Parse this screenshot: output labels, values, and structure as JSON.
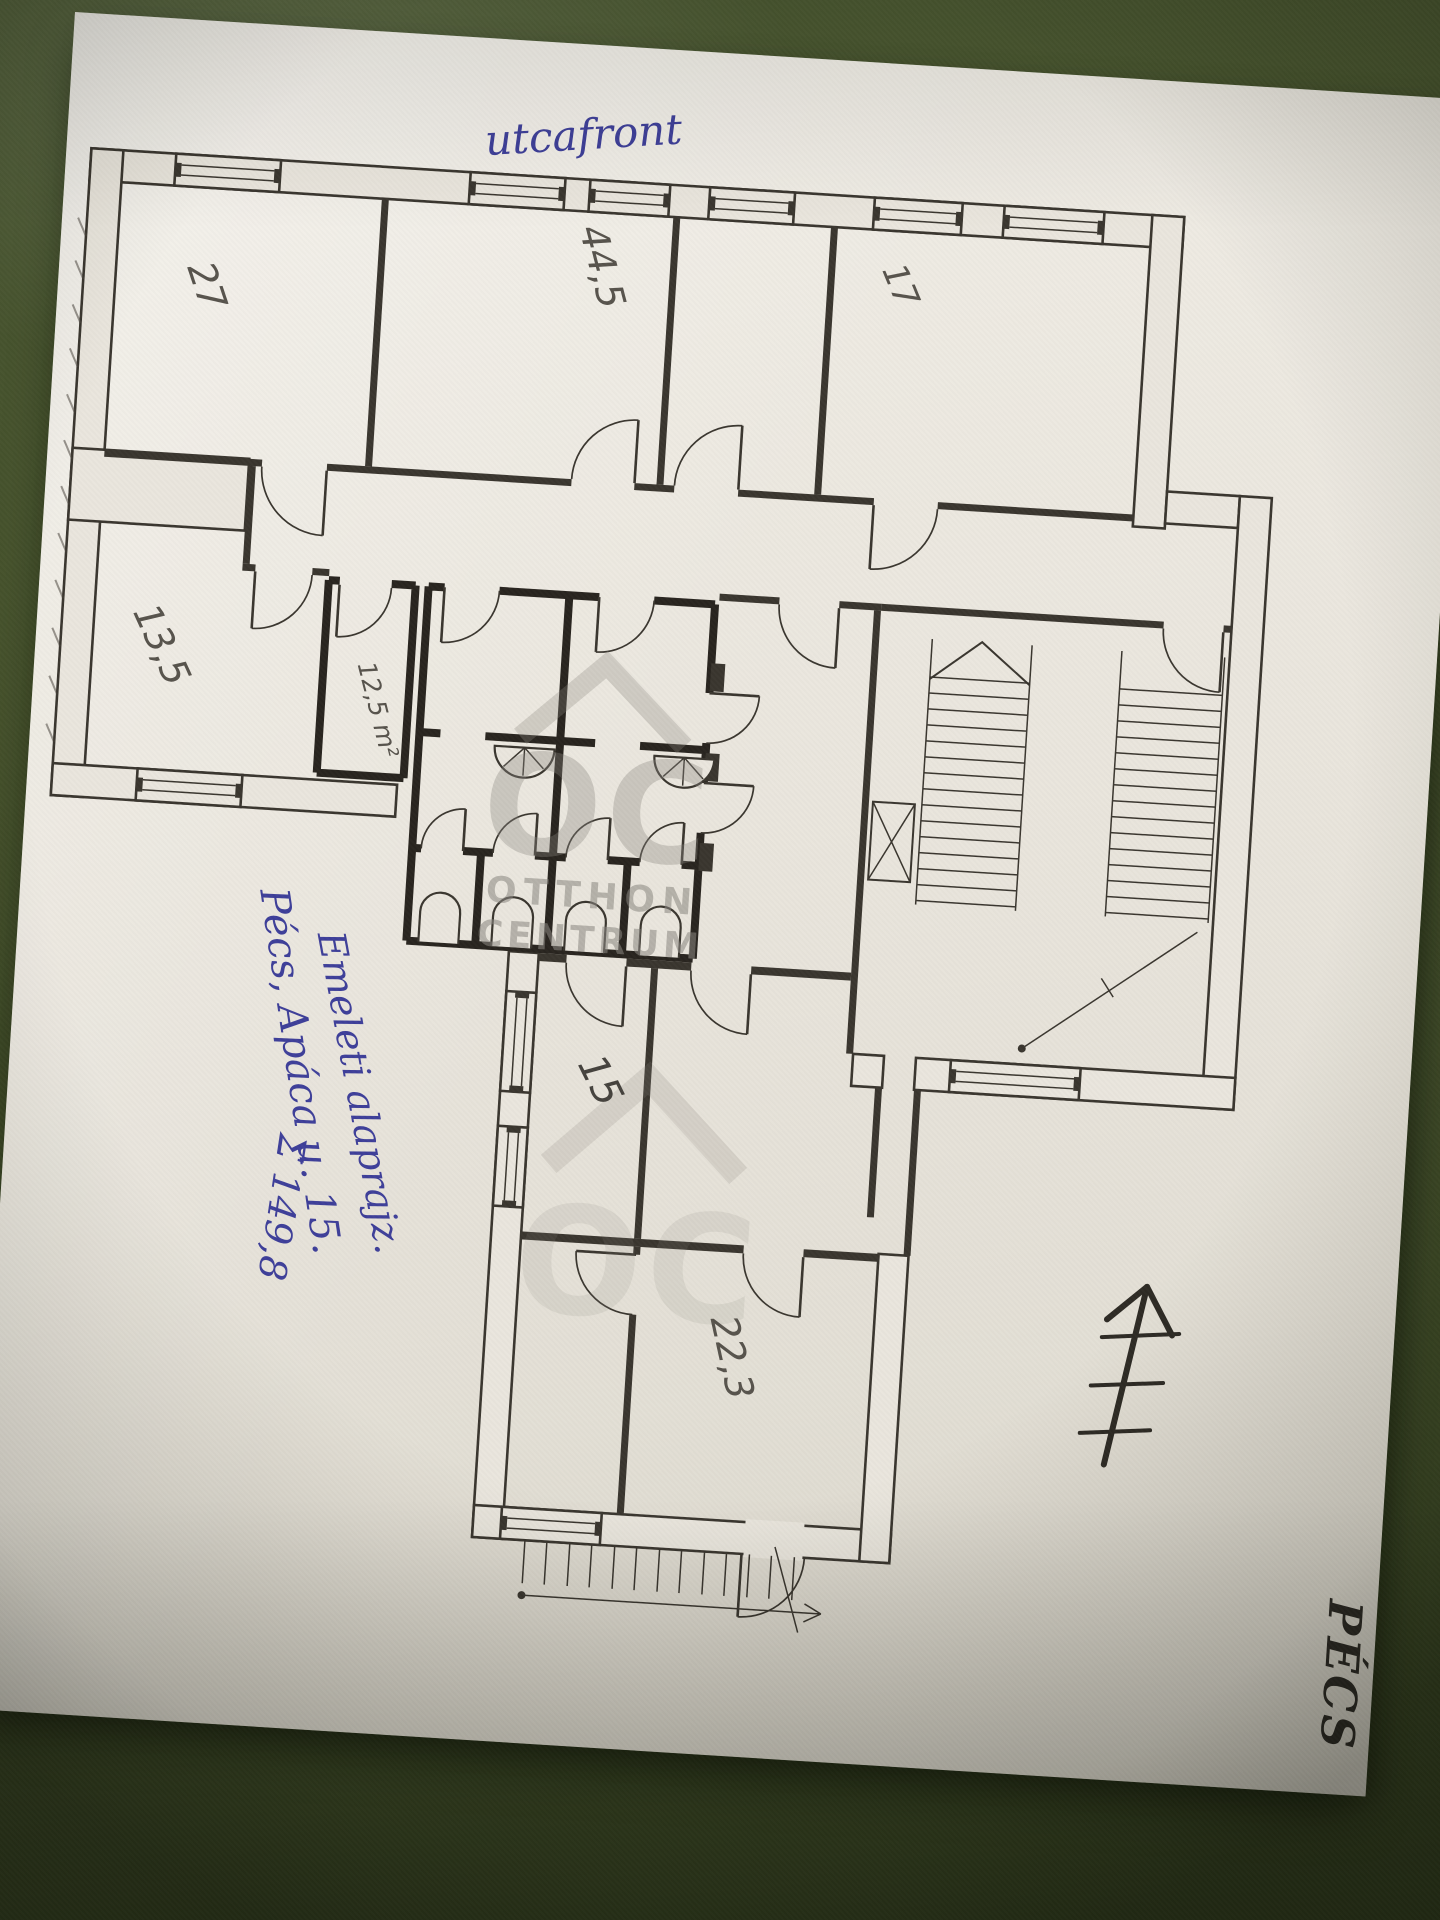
{
  "photo": {
    "background_color": "#46522c",
    "paper_color": "#eae6dd",
    "description": "hand-drawn floor plan on paper photographed on a dark green surface"
  },
  "plan": {
    "street_side_note": "utcafront",
    "room_labels": {
      "room27": "27",
      "room445": "44,5",
      "room17": "17",
      "room135": "13,5",
      "room125": "12,5 m²",
      "room15": "15",
      "room223": "22,3"
    },
    "notes": {
      "address": "Pécs, Apáca u. 15.",
      "plan_type": "Emeleti alaprajz.",
      "total_area": "Σ 149,8"
    },
    "corner_stamp": "PÉCS",
    "ink_color": "#3e3f99",
    "pencil_color": "#57534c",
    "line_color": "#3a362f"
  },
  "watermark": {
    "logo_text": "OC",
    "line1": "OTTHON",
    "line2": "CENTRUM",
    "color": "#8a8781"
  }
}
